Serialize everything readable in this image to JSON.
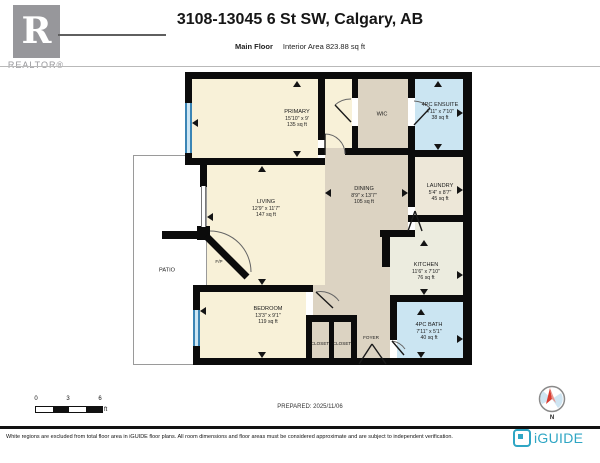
{
  "header": {
    "logo_letter": "R",
    "logo_label": "REALTOR®",
    "title": "3108-13045 6 St SW, Calgary, AB",
    "floor_label": "Main Floor",
    "area_label": "Interior Area 823.88 sq ft"
  },
  "rooms": {
    "primary": {
      "name": "PRIMARY",
      "dims": "15'10\" x 9'",
      "area": "135 sq ft"
    },
    "wic": {
      "name": "WIC"
    },
    "ensuite": {
      "name": "4PC ENSUITE",
      "dims": "4'11\" x 7'10\"",
      "area": "38 sq ft"
    },
    "living": {
      "name": "LIVING",
      "dims": "12'9\" x 11'7\"",
      "area": "147 sq ft"
    },
    "dining": {
      "name": "DINING",
      "dims": "8'9\" x 13'7\"",
      "area": "105 sq ft"
    },
    "laundry": {
      "name": "LAUNDRY",
      "dims": "5'4\" x 8'7\"",
      "area": "45 sq ft"
    },
    "kitchen": {
      "name": "KITCHEN",
      "dims": "11'6\" x 7'10\"",
      "area": "76 sq ft"
    },
    "bedroom": {
      "name": "BEDROOM",
      "dims": "13'3\" x 9'1\"",
      "area": "119 sq ft"
    },
    "bath": {
      "name": "4PC BATH",
      "dims": "7'11\" x 5'1\"",
      "area": "40 sq ft"
    },
    "foyer": {
      "name": "FOYER"
    },
    "closet1": {
      "name": "CLOSET"
    },
    "closet2": {
      "name": "CLOSET"
    },
    "patio": {
      "name": "PATIO"
    },
    "fireplace": {
      "name": "F/P"
    }
  },
  "footer": {
    "scale_ticks": [
      "0",
      "3",
      "6"
    ],
    "scale_unit": "ft",
    "prepared": "PREPARED: 2025/11/06",
    "compass_label": "N",
    "disclaimer": "White regions are excluded from total floor area in iGUIDE floor plans. All room dimensions and floor areas must be considered approximate and are subject to independent verification.",
    "brand": "iGUIDE"
  },
  "colors": {
    "wall": "#0b0b0b",
    "room_cream": "#f8f1d8",
    "room_tan": "#dcd3c2",
    "room_blue": "#cbe5f2",
    "room_pale": "#ececе1",
    "window_blue": "#4293c5",
    "brand_teal": "#2fa6c4",
    "compass_red": "#d93b30"
  }
}
